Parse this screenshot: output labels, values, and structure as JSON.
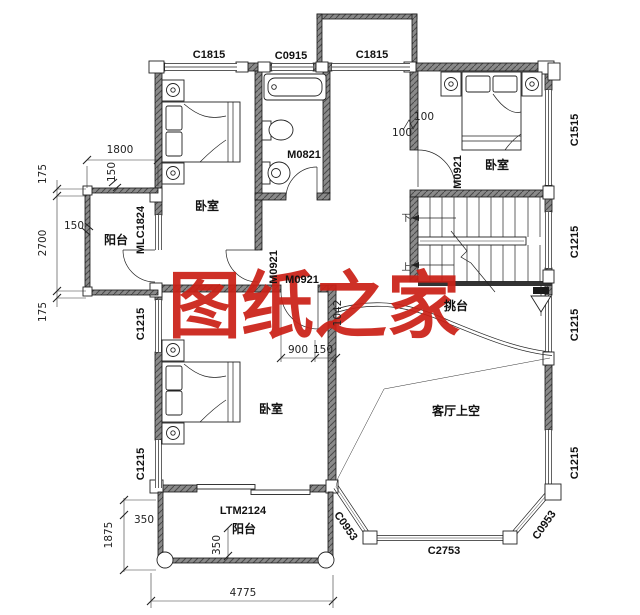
{
  "watermark": "图纸之家",
  "rooms": {
    "bedroom_tl": "卧室",
    "bedroom_tr": "卧室",
    "bedroom_bl": "卧室",
    "balcony_left": "阳台",
    "balcony_bottom": "阳台",
    "living_void": "客厅上空",
    "tiaotai": "挑台"
  },
  "stairs": {
    "up": "上",
    "down": "下"
  },
  "windows": {
    "c1815_left": "C1815",
    "c0915": "C0915",
    "c1815_terrace": "C1815",
    "c1515": "C1515",
    "c1215_right_upper": "C1215",
    "c1215_right_mid": "C1215",
    "c1215_right_lower": "C1215",
    "c1215_left_upper": "C1215",
    "c1215_left_lower": "C1215",
    "c0953_left": "C0953",
    "c2753": "C2753",
    "c0953_right": "C0953"
  },
  "doors": {
    "m0821": "M0821",
    "m0921_bedroom_tr": "M0921",
    "m0921_bedroom_tl": "M0921",
    "m0921_hall": "M0921",
    "mlc1824": "MLC1824",
    "ltm2124": "LTM2124"
  },
  "dimensions": {
    "w1800": "1800",
    "t175": "175",
    "wall150_top": "150",
    "left150": "150",
    "h2700": "2700",
    "b175": "175",
    "h1875": "1875",
    "v350": "350",
    "v350b": "350",
    "w4775": "4775",
    "off100a": "100",
    "off100b": "100",
    "d900": "900",
    "d150": "150",
    "d1042": "1042"
  }
}
